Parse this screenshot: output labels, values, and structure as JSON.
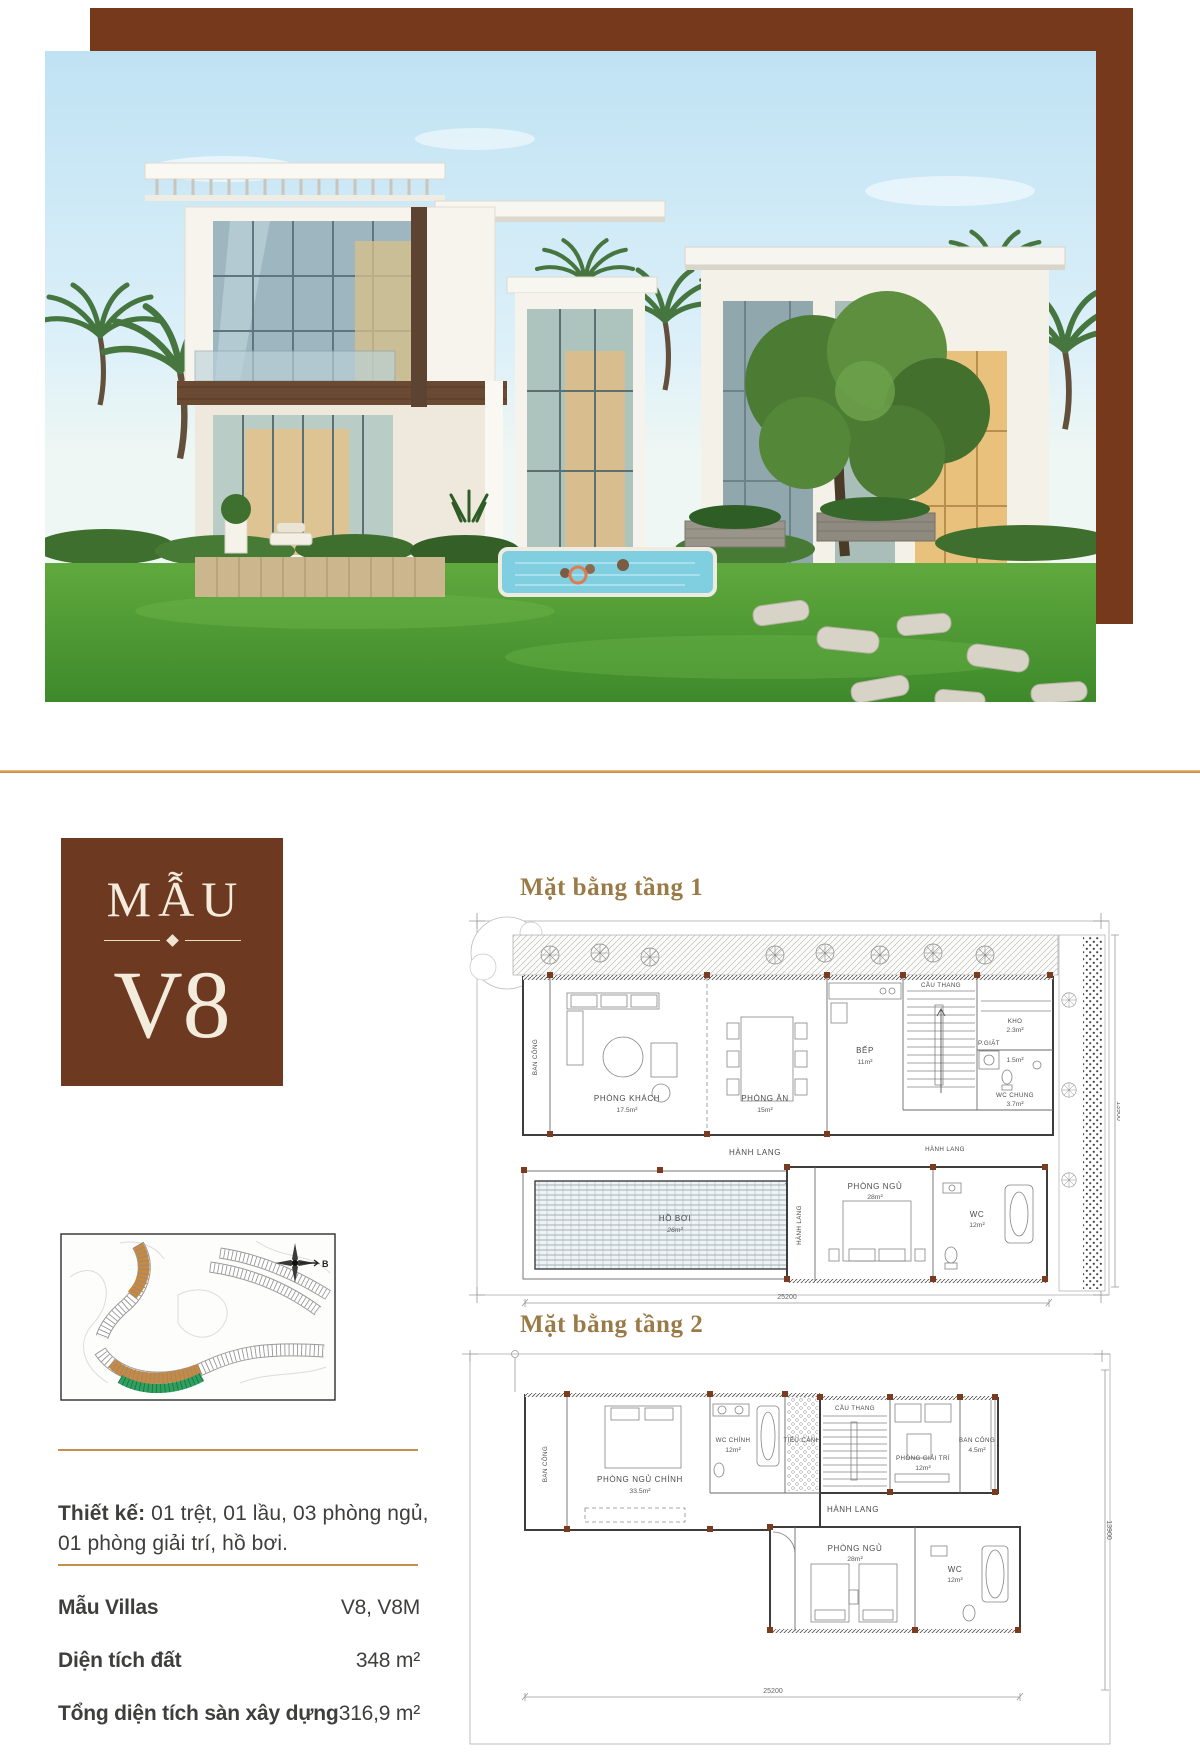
{
  "badge": {
    "title": "MẪU",
    "code": "V8"
  },
  "plan1": {
    "title": "Mặt bằng tầng 1",
    "balcony": "BAN CÔNG",
    "living": {
      "n": "PHÒNG KHÁCH",
      "a": "17.5m²"
    },
    "dining": {
      "n": "PHÒNG ĂN",
      "a": "15m²"
    },
    "kitchen": {
      "n": "BẾP",
      "a": "11m²"
    },
    "stairs": "CẦU THANG",
    "laundry": {
      "n": "P.GIẶT",
      "a": "1.5m²"
    },
    "storage": {
      "n": "KHO",
      "a": "2.3m²"
    },
    "wc_shared": {
      "n": "WC CHUNG",
      "a": "3.7m²"
    },
    "corridor": "HÀNH LANG",
    "pool": {
      "n": "HỒ BƠI",
      "a": "26m²"
    },
    "bedroom": {
      "n": "PHÒNG NGỦ",
      "a": "28m²"
    },
    "wc": {
      "n": "WC",
      "a": "12m²"
    },
    "dim_w": "25200",
    "dim_h": "13900"
  },
  "plan2": {
    "title": "Mặt bằng tầng 2",
    "balcony_left": "BAN CÔNG",
    "master": {
      "n": "PHÒNG NGỦ CHÍNH",
      "a": "33.5m²"
    },
    "wc_master": {
      "n": "WC CHÍNH",
      "a": "12m²"
    },
    "court": "TIỂU CẢNH",
    "stairs": "CẦU THANG",
    "entertainment": {
      "n": "PHÒNG GIẢI TRÍ",
      "a": "12m²"
    },
    "balcony_right": {
      "n": "BAN CÔNG",
      "a": "4.5m²"
    },
    "corridor": "HÀNH LANG",
    "bedroom": {
      "n": "PHÒNG NGỦ",
      "a": "28m²"
    },
    "wc": {
      "n": "WC",
      "a": "12m²"
    },
    "dim_w": "25200",
    "dim_h": "13900"
  },
  "sitemap": {
    "compass": "B"
  },
  "design": {
    "line1_bold": "Thiết kế:",
    "line1_rest": " 01 trệt, 01 lầu, 03 phòng ngủ,",
    "line2": "01 phòng giải trí, hồ bơi."
  },
  "specs": [
    {
      "label": "Mẫu Villas",
      "value": "V8, V8M"
    },
    {
      "label": "Diện tích đất",
      "value": "348 m²"
    },
    {
      "label": "Tổng diện tích sàn xây dựng",
      "value": "316,9 m²"
    }
  ],
  "colors": {
    "frame_brown": "#76391B",
    "badge_brown": "#6D3A21",
    "divider_gold": "#D99A55",
    "rule_gold": "#C3914F",
    "title_gold": "#9A7A46",
    "body_text": "#3E3E3C",
    "column_brick": "#7a3b1e",
    "sitemap_orange": "#C9893E",
    "sitemap_green": "#2FA05F"
  }
}
